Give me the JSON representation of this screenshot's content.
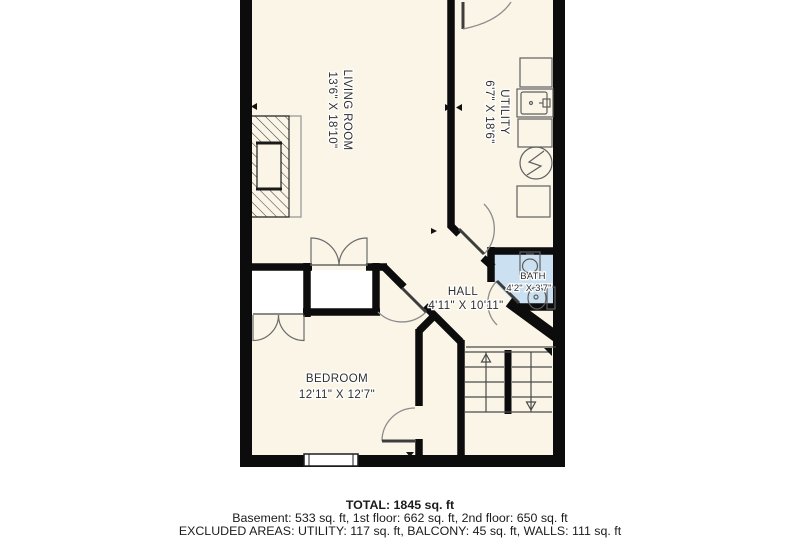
{
  "floorplan": {
    "rooms": [
      {
        "name": "LIVING ROOM",
        "dims": "13'6\" X 18'10\""
      },
      {
        "name": "UTILITY",
        "dims": "6'7\" X 18'6\""
      },
      {
        "name": "HALL",
        "dims": "4'11\" X 10'11\""
      },
      {
        "name": "BATH",
        "dims": "4'2\" X 3'7\""
      },
      {
        "name": "BEDROOM",
        "dims": "12'11\" X 12'7\""
      }
    ],
    "colors": {
      "background": "#ffffff",
      "floor": "#faf5e7",
      "bath_floor": "#cbe1f1",
      "closet_floor": "#ffffff",
      "wall": "#0c0c0c",
      "fixture_line": "#5f5f5f",
      "door_arc": "#8c8c8c",
      "label_text": "#2f2f2f",
      "footer_text": "#1b1b1b"
    }
  },
  "footer": {
    "total": "TOTAL: 1845 sq. ft",
    "floors": "Basement: 533 sq. ft, 1st floor: 662 sq. ft, 2nd floor: 650 sq. ft",
    "excluded": "EXCLUDED AREAS: UTILITY: 117 sq. ft, BALCONY: 45 sq. ft, WALLS: 111 sq. ft"
  }
}
